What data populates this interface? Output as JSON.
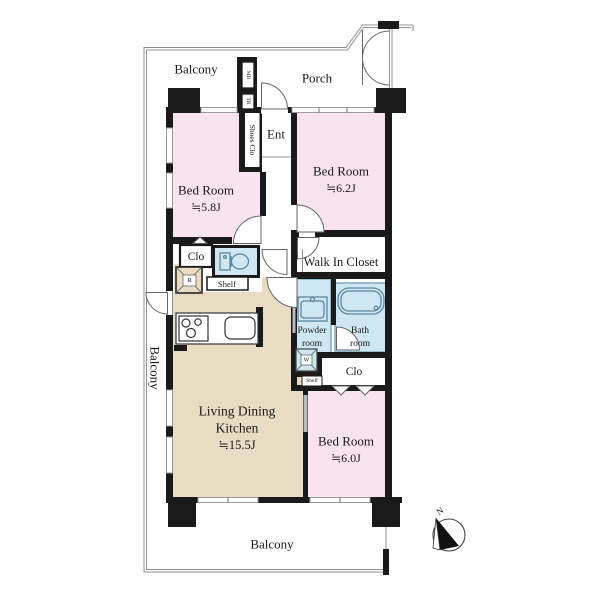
{
  "plan": {
    "balcony_top": "Balcony",
    "balcony_left": "Balcony",
    "balcony_bottom": "Balcony",
    "porch": "Porch",
    "ent": "Ent",
    "shoes_closet": "Shoes Clo",
    "meter_box": "MB",
    "trunk_room": "TR",
    "bedroom1": {
      "name": "Bed Room",
      "size": "≒5.8J"
    },
    "bedroom2": {
      "name": "Bed Room",
      "size": "≒6.2J"
    },
    "bedroom3": {
      "name": "Bed Room",
      "size": "≒6.0J"
    },
    "walk_in_closet": "Walk In Closet",
    "closet_top": "Clo",
    "closet_bottom": "Clo",
    "shelf_top": "Shelf",
    "shelf_bottom": "Shelf",
    "powder_room": {
      "line1": "Powder",
      "line2": "room"
    },
    "bath_room": {
      "line1": "Bath",
      "line2": "room"
    },
    "ldk": {
      "line1": "Living Dining",
      "line2": "Kitchen",
      "size": "≒15.5J"
    },
    "refrigerator": "R",
    "washer": "W",
    "compass_north": "N"
  },
  "colors": {
    "bedroom": "#f8e3ee",
    "ldk": "#e9dcc4",
    "wet": "#cfe7f2",
    "wall": "#1a1a1a",
    "window_gray": "#b9b9b9",
    "outline": "#909090"
  }
}
